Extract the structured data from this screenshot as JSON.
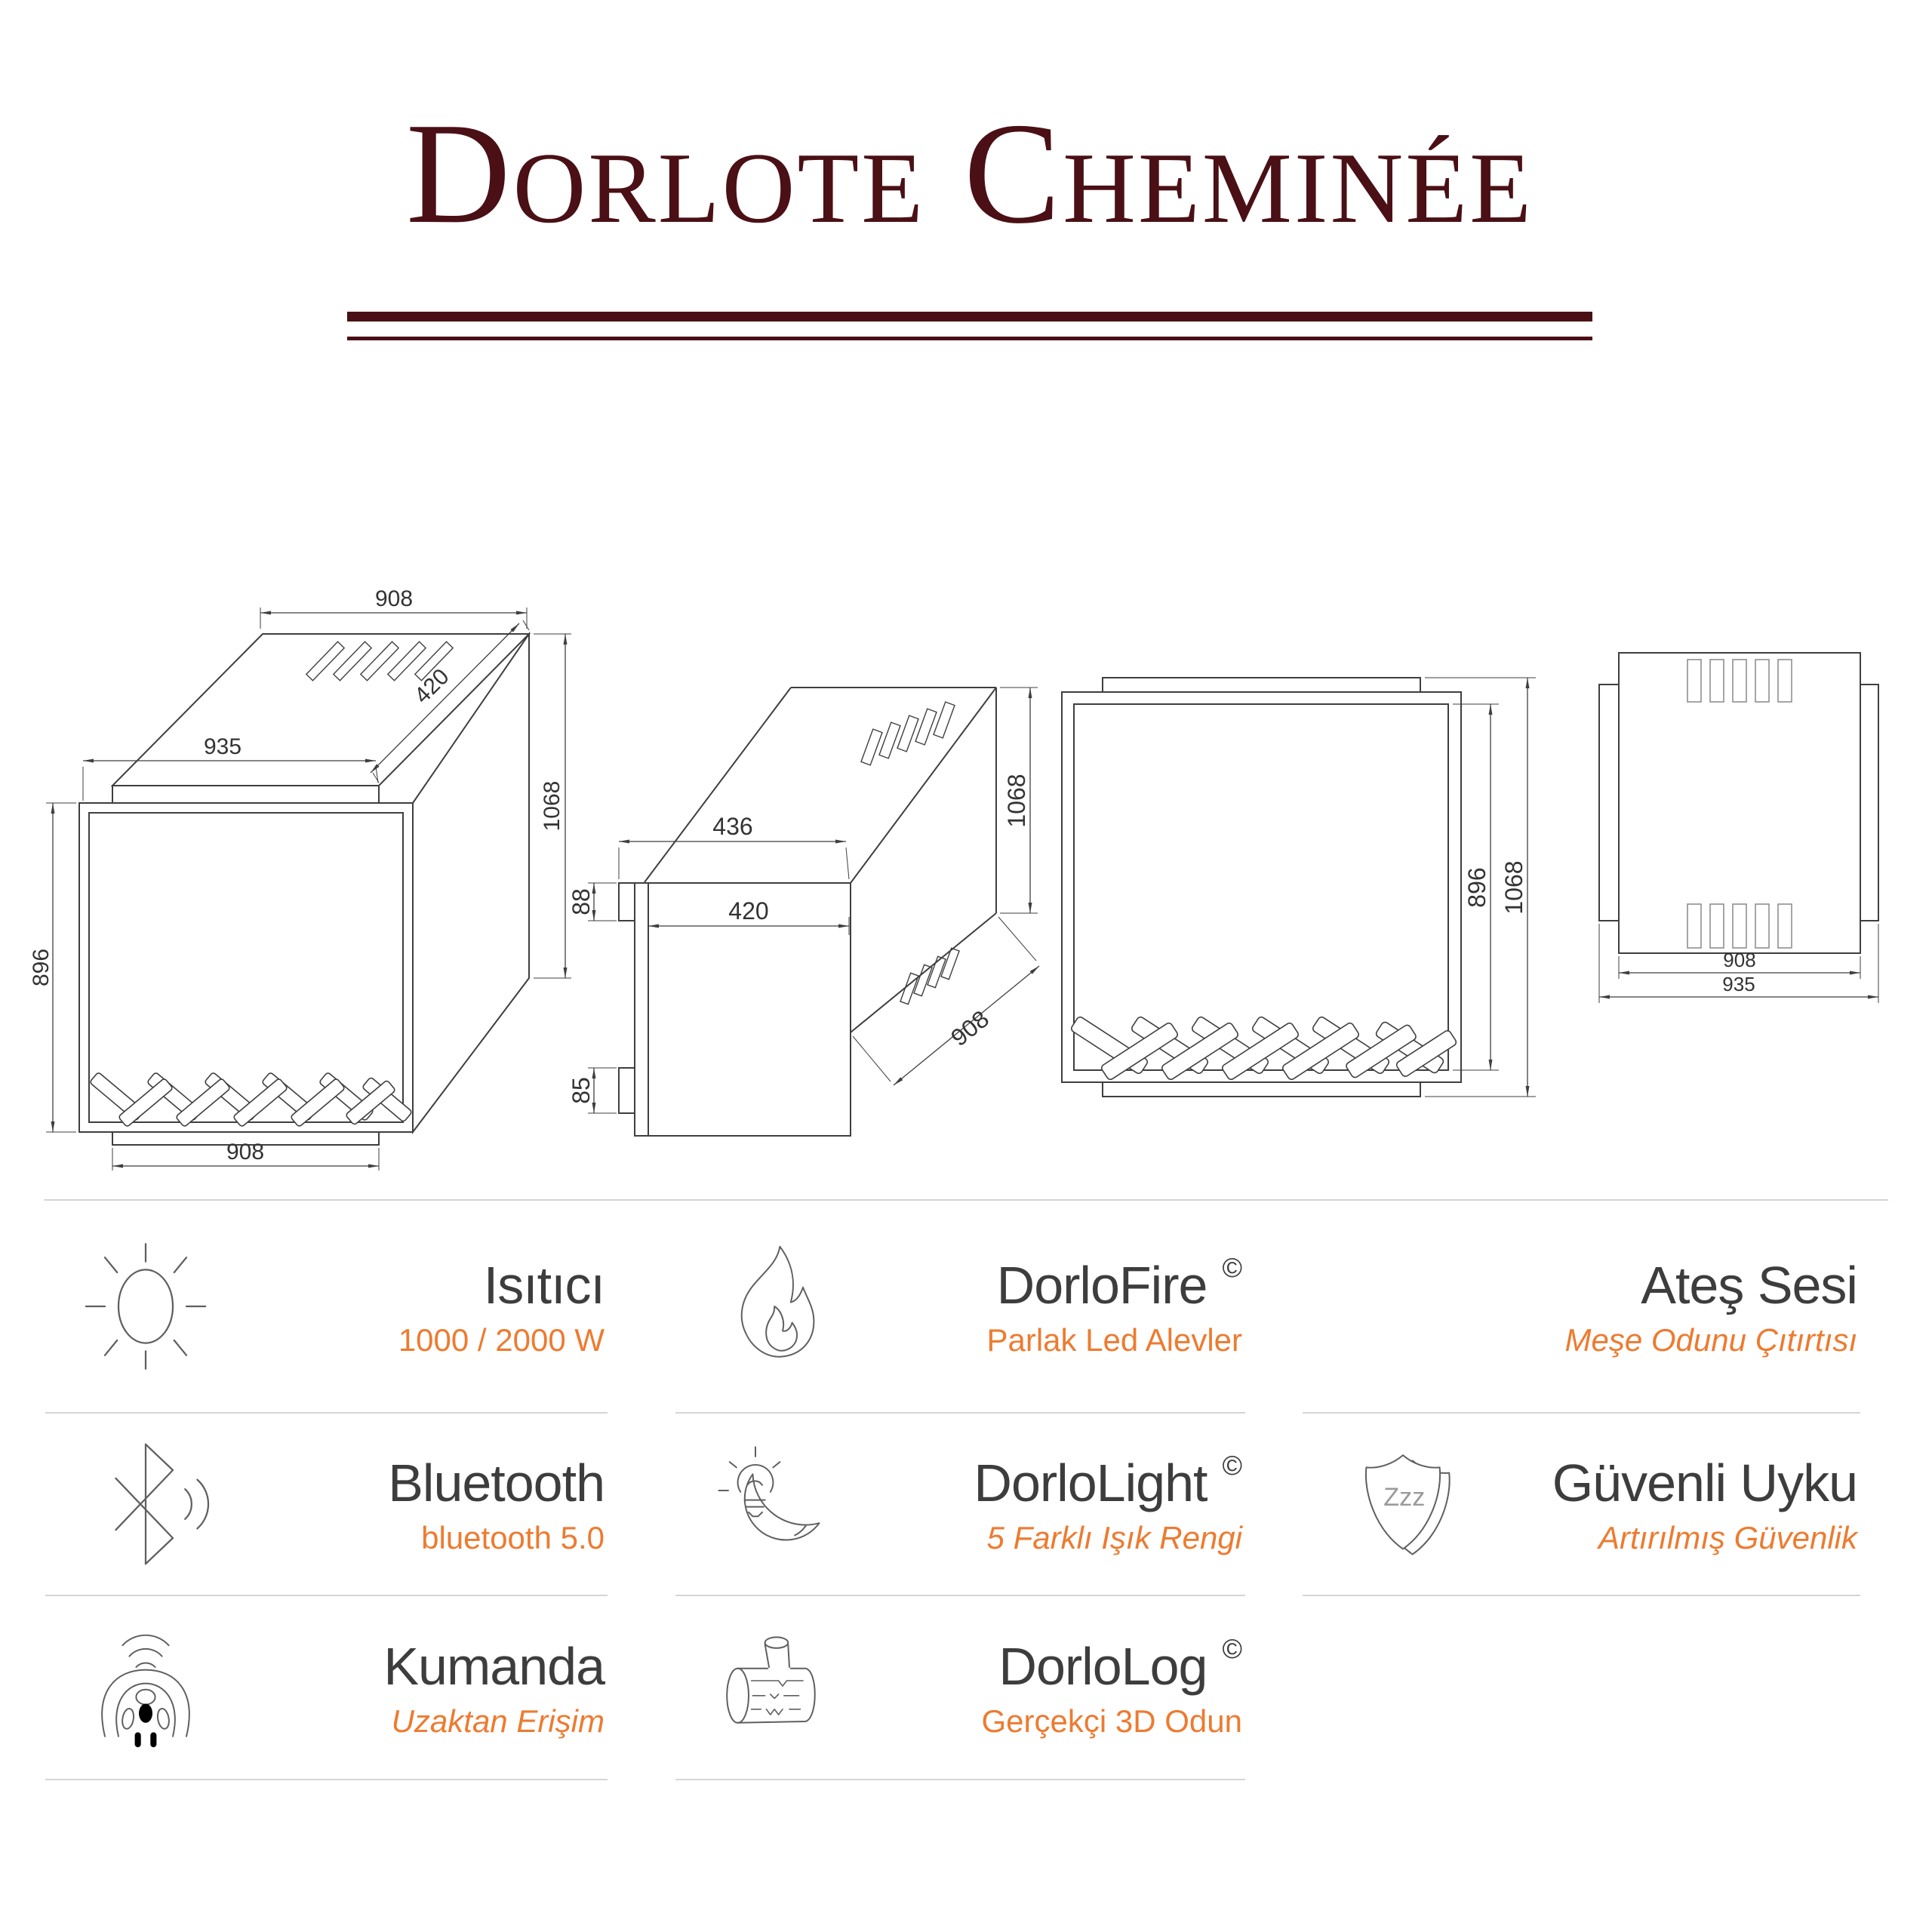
{
  "header": {
    "title": "Dorlote Cheminée",
    "title_color": "#4a1015"
  },
  "colors": {
    "accent_orange": "#ed7b30",
    "feature_title": "#3d3d3d",
    "drawing_line": "#3f3f3f",
    "divider": "#d5d5d5"
  },
  "drawings": {
    "iso": {
      "view": "isometric-view",
      "top_width": "908",
      "depth": "420",
      "plate_width": "935",
      "side_height": "1068",
      "front_height": "896",
      "bottom_width": "908"
    },
    "side": {
      "view": "side-view",
      "top_depth": "436",
      "door_depth": "420",
      "top_offset": "88",
      "bottom_offset": "85",
      "height": "1068",
      "width": "908"
    },
    "front": {
      "view": "front-view",
      "glass_height": "896",
      "height": "1068"
    },
    "top": {
      "view": "top-view",
      "inner_width": "908",
      "width": "935"
    }
  },
  "features": {
    "columns": [
      {
        "cells": [
          {
            "icon": "sun-icon",
            "title": "Isıtıcı",
            "subtitle": "1000 / 2000 W"
          },
          {
            "icon": "bluetooth-icon",
            "title": "Bluetooth",
            "subtitle": "bluetooth 5.0"
          },
          {
            "icon": "remote-icon",
            "title": "Kumanda",
            "subtitle": "Uzaktan Erişim"
          }
        ]
      },
      {
        "cells": [
          {
            "icon": "flame-icon",
            "title": "DorloFire",
            "mark": "©",
            "subtitle": "Parlak Led Alevler"
          },
          {
            "icon": "bulb-moon-icon",
            "title": "DorloLight",
            "mark": "©",
            "subtitle": "5 Farklı Işık Rengi"
          },
          {
            "icon": "log-icon",
            "title": "DorloLog",
            "mark": "©",
            "subtitle": "Gerçekçi 3D Odun"
          }
        ]
      },
      {
        "cells": [
          {
            "icon": "",
            "title": "Ateş Sesi",
            "subtitle": "Meşe Odunu Çıtırtısı"
          },
          {
            "icon": "shield-icon",
            "icon_text": "Zzz",
            "title": "Güvenli Uyku",
            "subtitle": "Artırılmış Güvenlik"
          }
        ]
      }
    ]
  }
}
